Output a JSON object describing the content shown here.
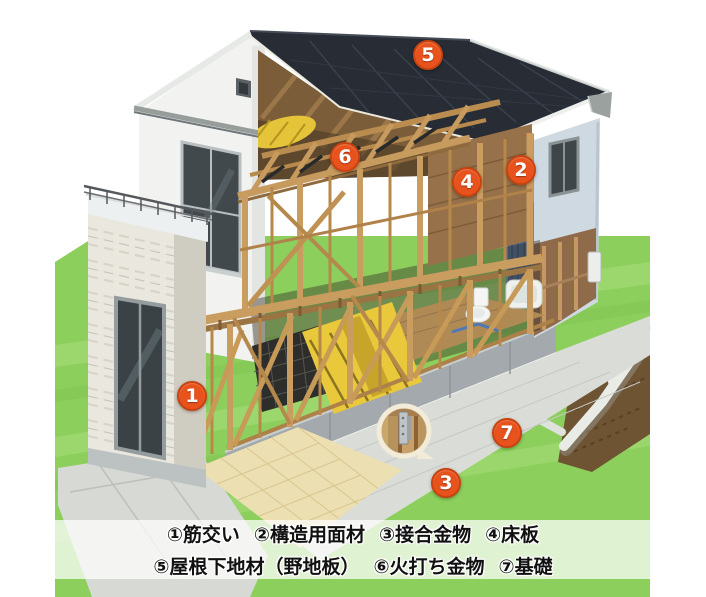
{
  "markers": [
    {
      "number": "1",
      "x": 192,
      "y": 396,
      "term": "筋交い"
    },
    {
      "number": "2",
      "x": 521,
      "y": 170,
      "term": "構造用面材"
    },
    {
      "number": "3",
      "x": 446,
      "y": 483,
      "term": "接合金物"
    },
    {
      "number": "4",
      "x": 467,
      "y": 182,
      "term": "床板"
    },
    {
      "number": "5",
      "x": 428,
      "y": 55,
      "term": "屋根下地材（野地板）"
    },
    {
      "number": "6",
      "x": 345,
      "y": 157,
      "term": "火打ち金物"
    },
    {
      "number": "7",
      "x": 507,
      "y": 433,
      "term": "基礎"
    }
  ],
  "legend": {
    "rows": [
      [
        {
          "num": "①",
          "label": "筋交い"
        },
        {
          "num": "②",
          "label": "構造用面材"
        },
        {
          "num": "③",
          "label": "接合金物"
        },
        {
          "num": "④",
          "label": "床板"
        }
      ],
      [
        {
          "num": "⑤",
          "label": "屋根下地材（野地板）"
        },
        {
          "num": "⑥",
          "label": "火打ち金物"
        },
        {
          "num": "⑦",
          "label": "基礎"
        }
      ]
    ]
  },
  "colors": {
    "marker_fill": "#e8521d",
    "marker_ring": "#c8430f",
    "roof": "#272c35",
    "grass": "#8ccf5c",
    "wood": "#c79a5e",
    "wall_white": "#f2f3f1",
    "wall_blue_grey": "#cfd9e2",
    "concrete": "#a3a9ac",
    "soil": "#6f5434",
    "insulation_yellow": "#e9c83b",
    "legend_background": "rgba(255,255,255,0.72)",
    "legend_text": "#111111"
  }
}
